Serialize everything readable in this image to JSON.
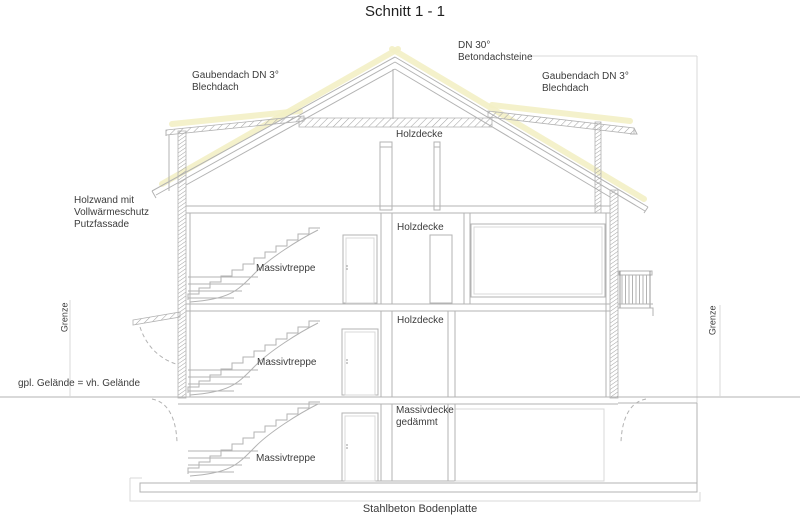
{
  "title": "Schnitt 1 - 1",
  "labels": {
    "roof_main": "DN 30°\nBetondachsteine",
    "dormer_left": "Gaubendach DN 3°\nBlechdach",
    "dormer_right": "Gaubendach DN 3°\nBlechdach",
    "wall_left": "Holzwand mit\nVollwärmeschutz\nPutzfassade",
    "ceiling_attic": "Holzdecke",
    "ceiling_upper": "Holzdecke",
    "ceiling_ground": "Holzdecke",
    "ceiling_basement": "Massivdecke\ngedämmt",
    "stairs_upper": "Massivtreppe",
    "stairs_ground": "Massivtreppe",
    "stairs_basement": "Massivtreppe",
    "ground_line": "gpl. Gelände = vh. Gelände",
    "boundary_left": "Grenze",
    "boundary_right": "Grenze",
    "foundation": "Stahlbeton Bodenplatte"
  },
  "colors": {
    "line": "#b3b3b3",
    "line_dark": "#989898",
    "text": "#3c3c3c",
    "roof_highlight": "#f3efc5",
    "background": "#ffffff"
  }
}
